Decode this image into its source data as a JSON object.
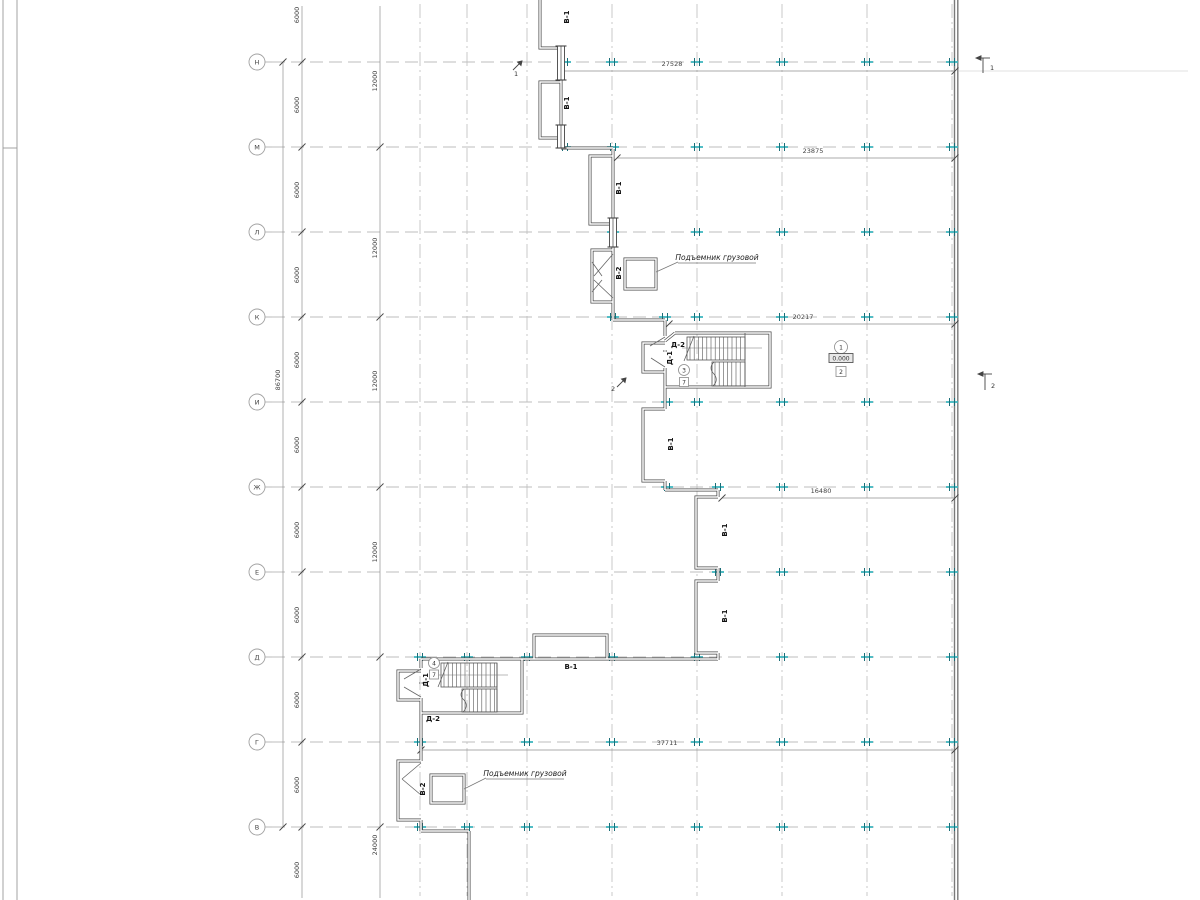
{
  "grid_rows": [
    "Н",
    "М",
    "Л",
    "К",
    "И",
    "Ж",
    "Е",
    "Д",
    "Г",
    "В"
  ],
  "dims": {
    "bay": "6000",
    "double_bay": "12000",
    "below": "24000",
    "total": "86700",
    "h1": "27528",
    "h2": "23875",
    "h3": "20217",
    "h4": "16480",
    "h5": "37711"
  },
  "openings": {
    "b1": "В-1",
    "b2": "В-2",
    "d1": "Д-1",
    "d2": "Д-2"
  },
  "notes": {
    "hoist": "Подъемник грузовой"
  },
  "tags": {
    "stair_mid_room": "3",
    "stair_mid_finish": "7",
    "stair_low_room": "4",
    "stair_low_finish": "7",
    "hall_room": "1",
    "hall_level": "0.000",
    "hall_finish": "2"
  },
  "sections": {
    "s1": "1",
    "s2": "2"
  },
  "colors": {
    "tick": "#3fb6bf",
    "tick_dark": "#1a6e78",
    "wall": "#4a4a4a",
    "grid": "#b3b3b3",
    "dimline": "#8f8f8f"
  }
}
